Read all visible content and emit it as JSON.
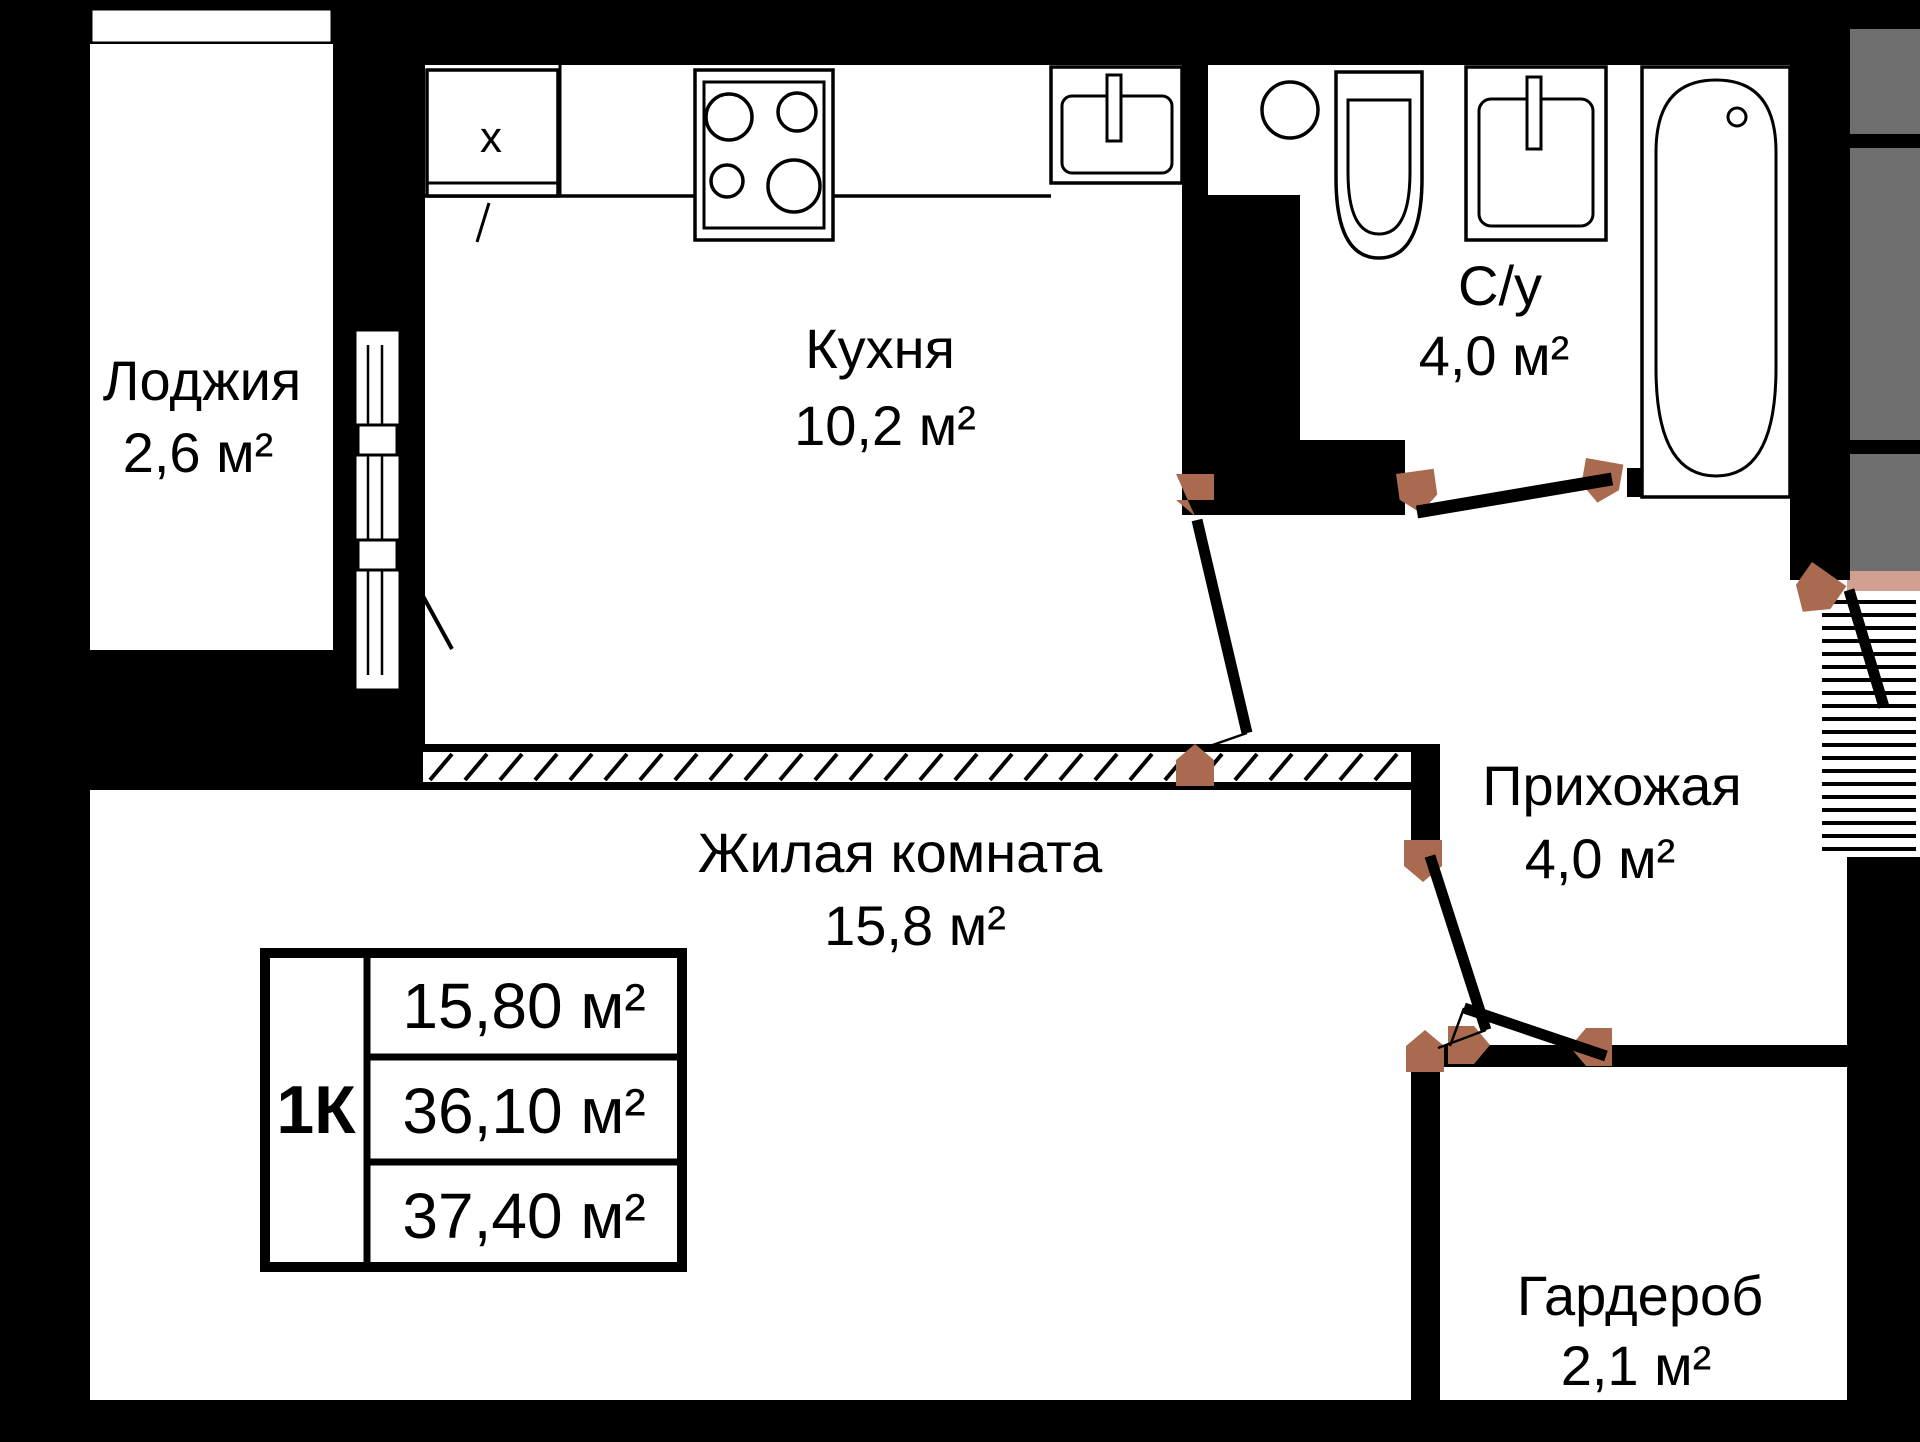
{
  "rooms": [
    {
      "name": "Лоджия",
      "area": "2,6 м²"
    },
    {
      "name": "Кухня",
      "area": "10,2 м²"
    },
    {
      "name": "С/у",
      "area": "4,0 м²"
    },
    {
      "name": "Прихожая",
      "area": "4,0 м²"
    },
    {
      "name": "Жилая комната",
      "area": "15,8 м²"
    },
    {
      "name": "Гардероб",
      "area": "2,1 м²"
    }
  ],
  "info_table": {
    "type": "1К",
    "living_area": "15,80 м²",
    "apartment_area": "36,10 м²",
    "total_area": "37,40 м²"
  },
  "fixtures": {
    "cabinet_mark": "х"
  },
  "colors": {
    "wall": "#000000",
    "floor": "#ffffff",
    "door_hinge": "#a96a50",
    "neighbor_gray": "#6f6f6f",
    "threshold_pink": "#d2a090"
  }
}
